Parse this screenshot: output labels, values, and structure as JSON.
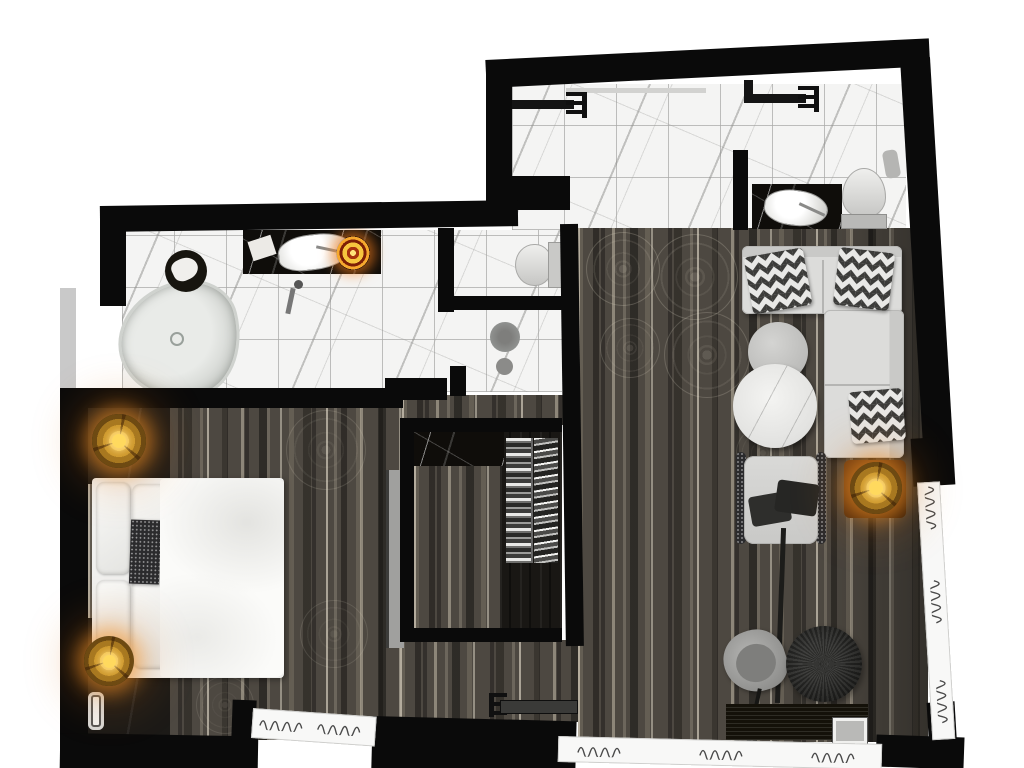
{
  "scene": {
    "type": "floor-plan",
    "description": "Top-view 3D-rendered floor plan of a hotel suite with two marble bathrooms, bedroom, walk-in closet and living room"
  },
  "rooms": {
    "shower_bathroom": {
      "label": "shower bathroom with marble tile floor, two rain shower arms, black marble vanity with sink, and toilet"
    },
    "ensuite_bathroom": {
      "label": "ensuite bathroom with freestanding bathtub, black marble vanity with sink and glowing candle ring, and stool with towel"
    },
    "wc": {
      "label": "toilet compartment"
    },
    "shower_stall": {
      "label": "shower stall with floor drain"
    },
    "corridor": {
      "label": "carpeted corridor with damask medallion pattern"
    },
    "bedroom": {
      "label": "bedroom with double bed, dark nightstands and glowing bedside lamps"
    },
    "closet": {
      "label": "walk-in closet with black marble counter and hanging clothes"
    },
    "living_room": {
      "label": "living room with sectional sofa, round marble coffee tables, armchair, side table lamp, desk chair, round pouf and media console"
    },
    "entry": {
      "label": "entry with sliding door"
    }
  },
  "furniture": {
    "rain_shower_left": "rain shower arm",
    "rain_shower_right": "rain shower arm",
    "vanity_sink_top": "black marble vanity with vessel sink",
    "toilet_top": "toilet",
    "towel_roll": "towel",
    "bathtub": "freestanding bathtub",
    "tub_faucet": "floor-mounted tub faucet",
    "stool_towel": "stool with towel",
    "vanity_sink_left": "black marble vanity with vessel sink",
    "candle_ring": "glowing candle ring",
    "toilet_wc": "toilet",
    "floor_drain": "shower floor drain",
    "bed": "double bed with white duvet and pillows",
    "accent_throw": "dark patterned throw pillow",
    "nightstand_north": "nightstand",
    "nightstand_south": "nightstand",
    "bedside_lamp_north": "glowing bedside lamp",
    "bedside_lamp_south": "glowing bedside lamp",
    "phone": "telephone",
    "bedroom_console": "wall console",
    "closet_counter": "black marble counter",
    "hanging_clothes": "hanging clothes rails",
    "sectional_sofa": "L-shaped sectional sofa",
    "chevron_pillow": "chevron zigzag cushion",
    "coffee_table_large": "large round marble coffee table",
    "coffee_table_small": "small round marble coffee table",
    "armchair": "armchair with dark throw pillows",
    "side_table": "wooden side table",
    "table_lamp": "glowing table lamp",
    "desk_chair": "swivel chair",
    "round_pouf": "round dark pouf",
    "media_console": "low media console",
    "framed_photo": "framed picture",
    "entry_door": "sliding entry door",
    "curtain": "window with curtain symbol"
  },
  "palette": {
    "wall": "#0a0a0a",
    "marble_tile": "#f4f4f3",
    "tile_grid": "#aaaaa8",
    "black_marble": "#0f0d0a",
    "carpet_dark": "#4d4841",
    "carpet_streak": "#cfc6b2",
    "closet_floor": "#191714",
    "sofa": "#d8d8d6",
    "lamp_glow": "#f2b43e",
    "lamp_glow_deep": "#c47c16",
    "window": "#f8f8f7",
    "exterior": "#ffffff"
  }
}
